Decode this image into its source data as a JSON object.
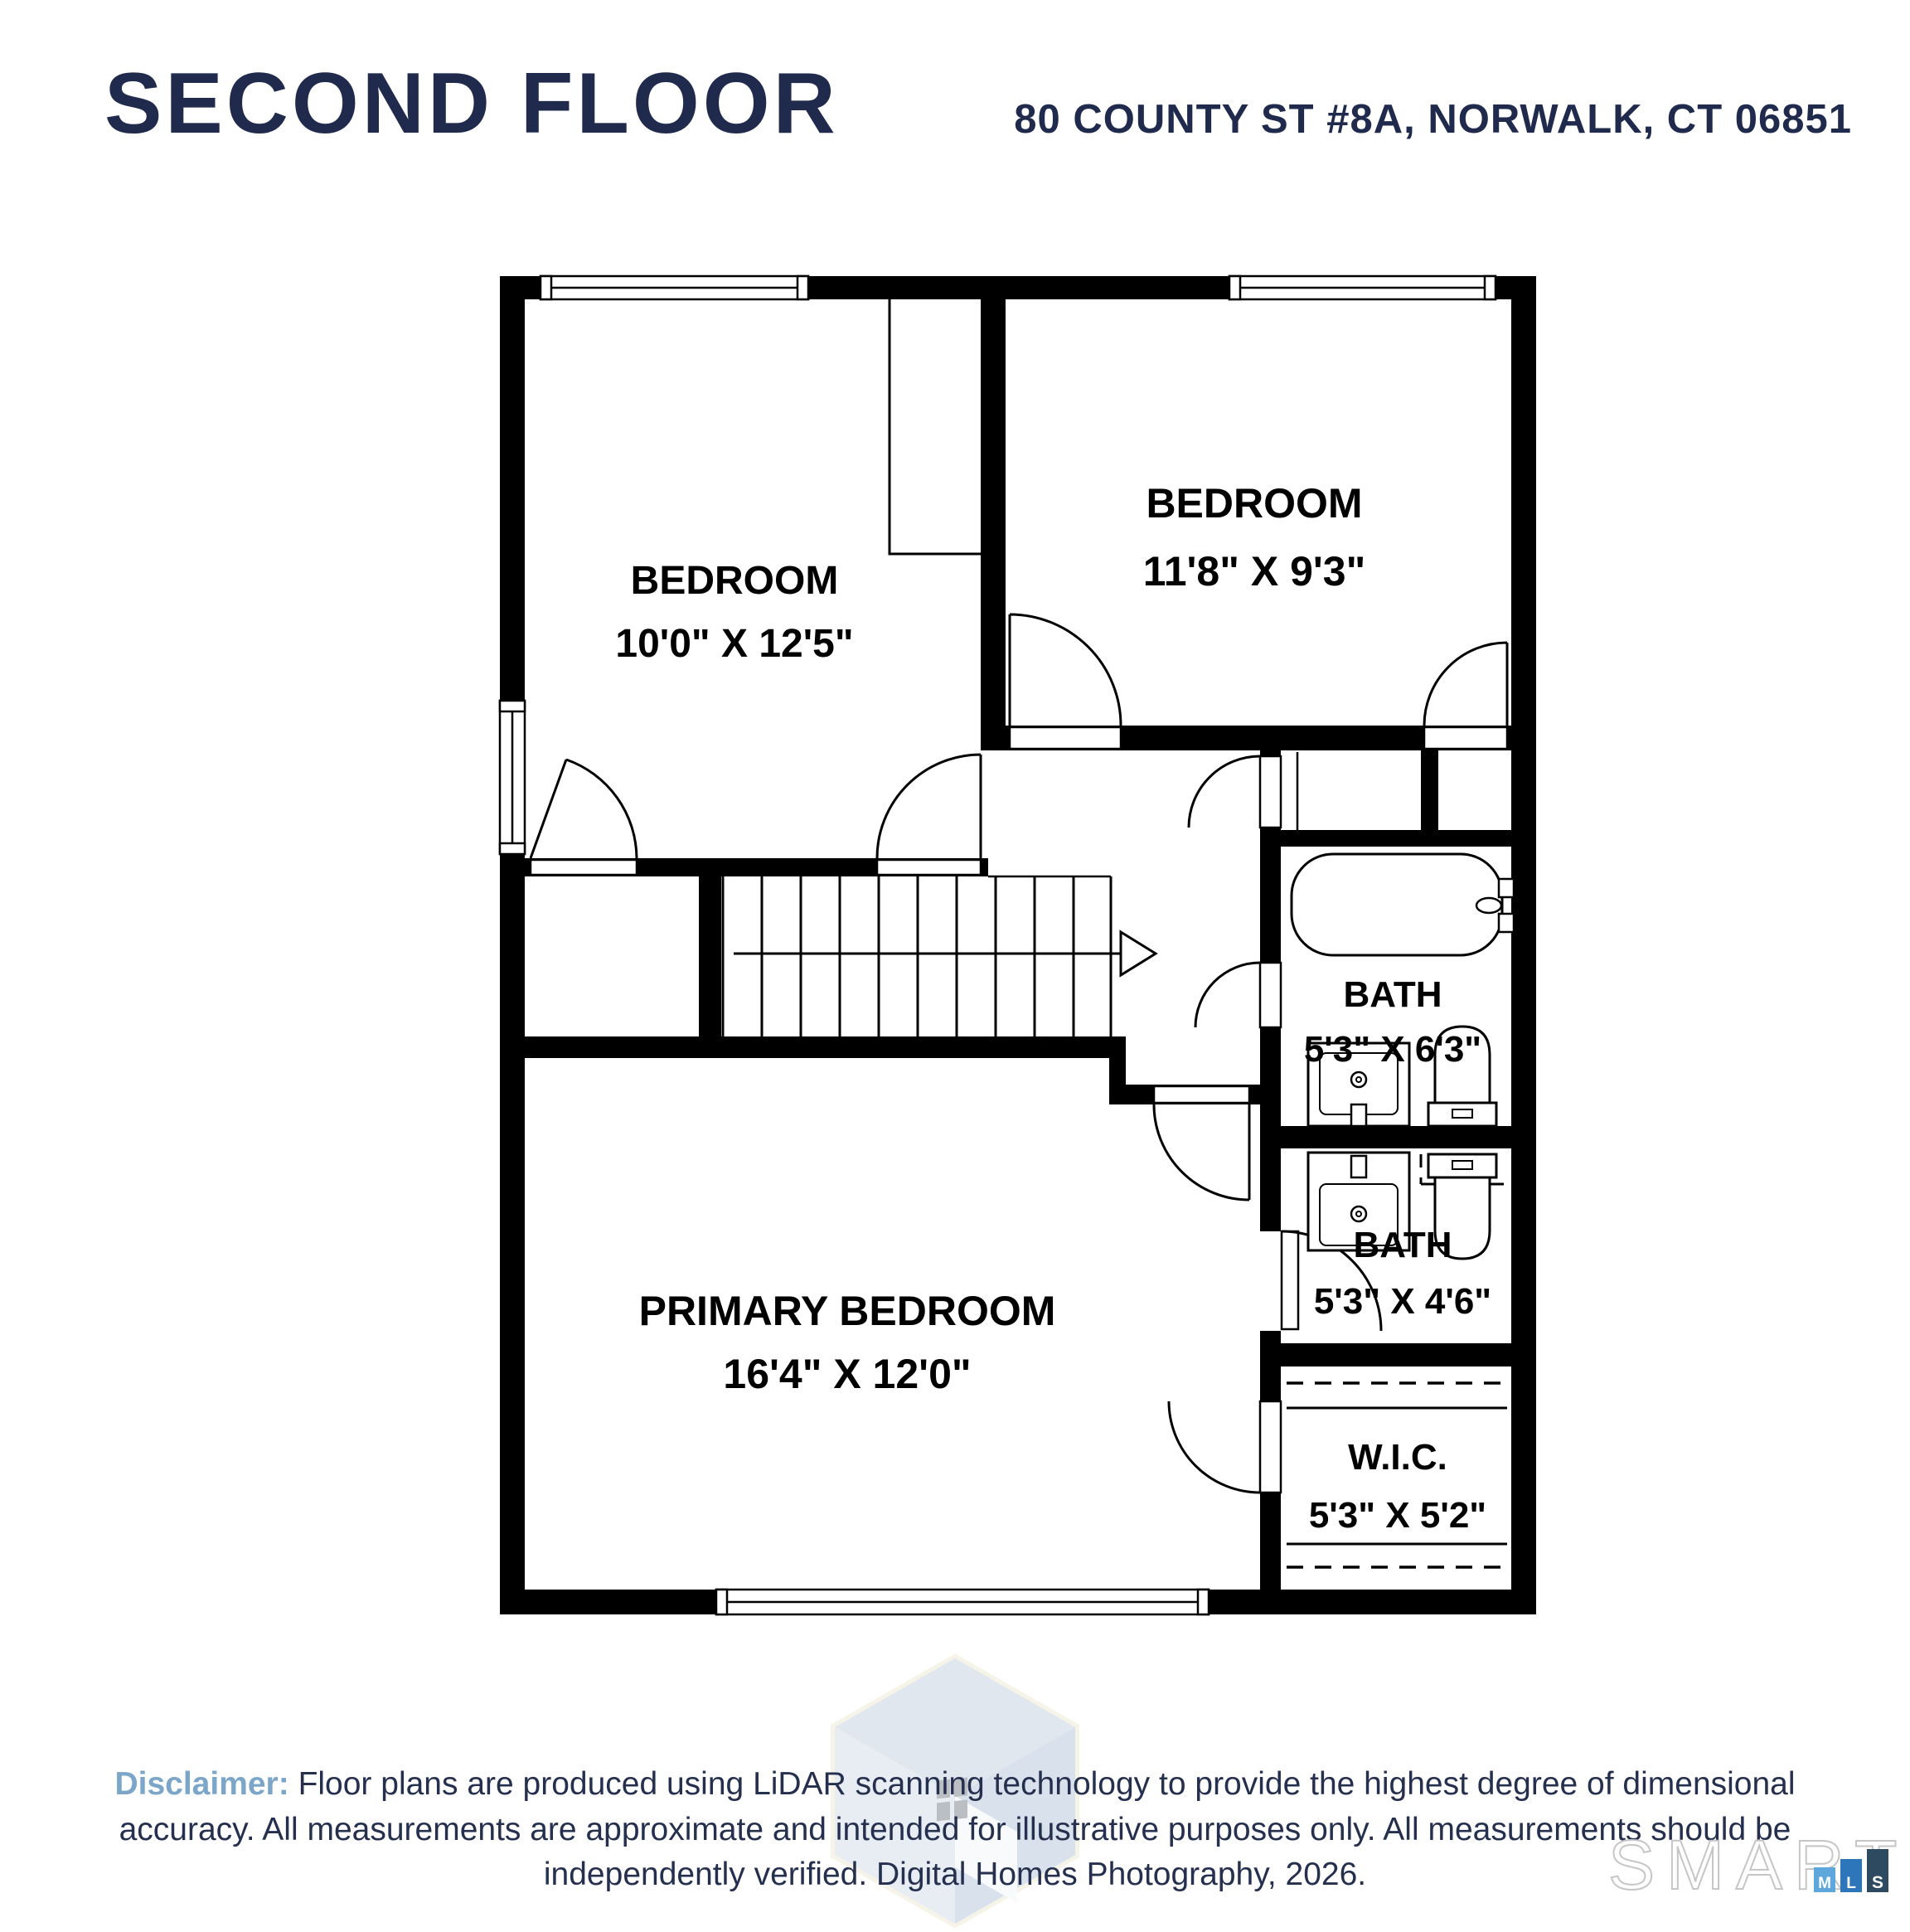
{
  "header": {
    "title": "SECOND FLOOR",
    "address": "80 COUNTY ST #8A, NORWALK, CT 06851"
  },
  "rooms": {
    "bedroom_1": {
      "name": "BEDROOM",
      "dims": "10'0\" X 12'5\""
    },
    "bedroom_2": {
      "name": "BEDROOM",
      "dims": "11'8\" X 9'3\""
    },
    "bath_upper": {
      "name": "BATH",
      "dims": "5'3\" X 6'3\""
    },
    "bath_lower": {
      "name": "BATH",
      "dims": "5'3\" X 4'6\""
    },
    "primary_bedroom": {
      "name": "PRIMARY BEDROOM",
      "dims": "16'4\" X 12'0\""
    },
    "wic": {
      "name": "W.I.C.",
      "dims": "5'3\" X 5'2\""
    }
  },
  "disclaimer": {
    "label": "Disclaimer:",
    "text": " Floor plans are produced using LiDAR scanning technology to provide the highest degree of dimensional accuracy. All measurements are approximate and intended for illustrative purposes only. All measurements should be independently verified. Digital Homes Photography, 2026."
  },
  "logo": {
    "word": "SMART",
    "bars": [
      {
        "letter": "M",
        "color": "#5ea7dd"
      },
      {
        "letter": "L",
        "color": "#2e76ba"
      },
      {
        "letter": "S",
        "color": "#2d4a60"
      }
    ]
  },
  "colors": {
    "heading_navy": "#1f2a4d",
    "disclaimer_body": "#25304f",
    "disclaimer_accent": "#7ba6c9",
    "walls": "#000000"
  }
}
